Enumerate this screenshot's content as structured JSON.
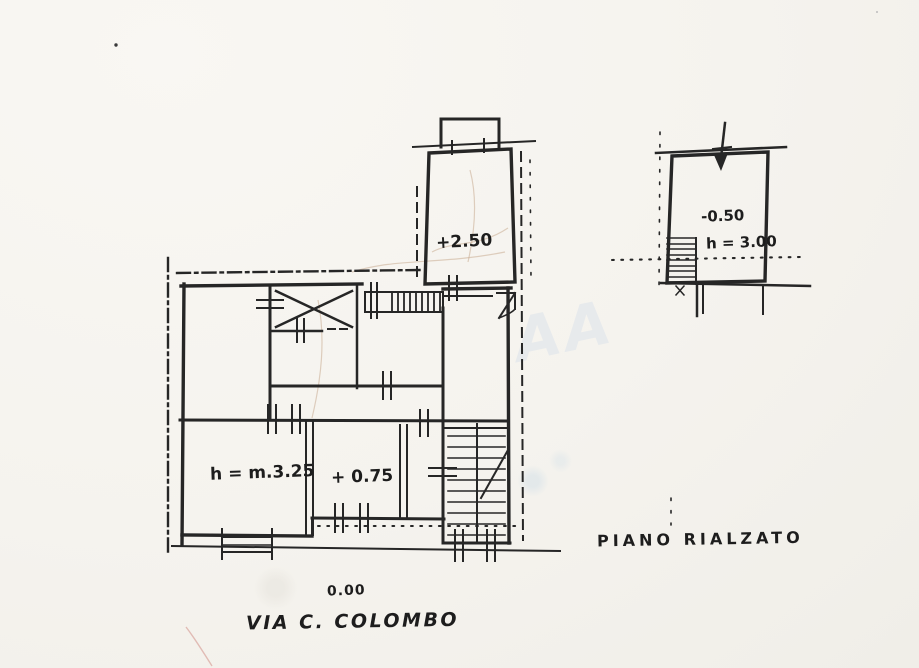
{
  "plan": {
    "labels": {
      "upper_level": "+2.50",
      "annex_level": "-0.50",
      "annex_height": "h = 3.00",
      "room_height": "h = m.3.25",
      "mid_level": "+ 0.75",
      "street_level": "0.00",
      "street_name": "VIA C. COLOMBO",
      "floor_name": "PIANO RIALZATO",
      "watermark": "AA"
    },
    "colors": {
      "ink": "#262626",
      "paper": "#f5f3ee"
    }
  }
}
